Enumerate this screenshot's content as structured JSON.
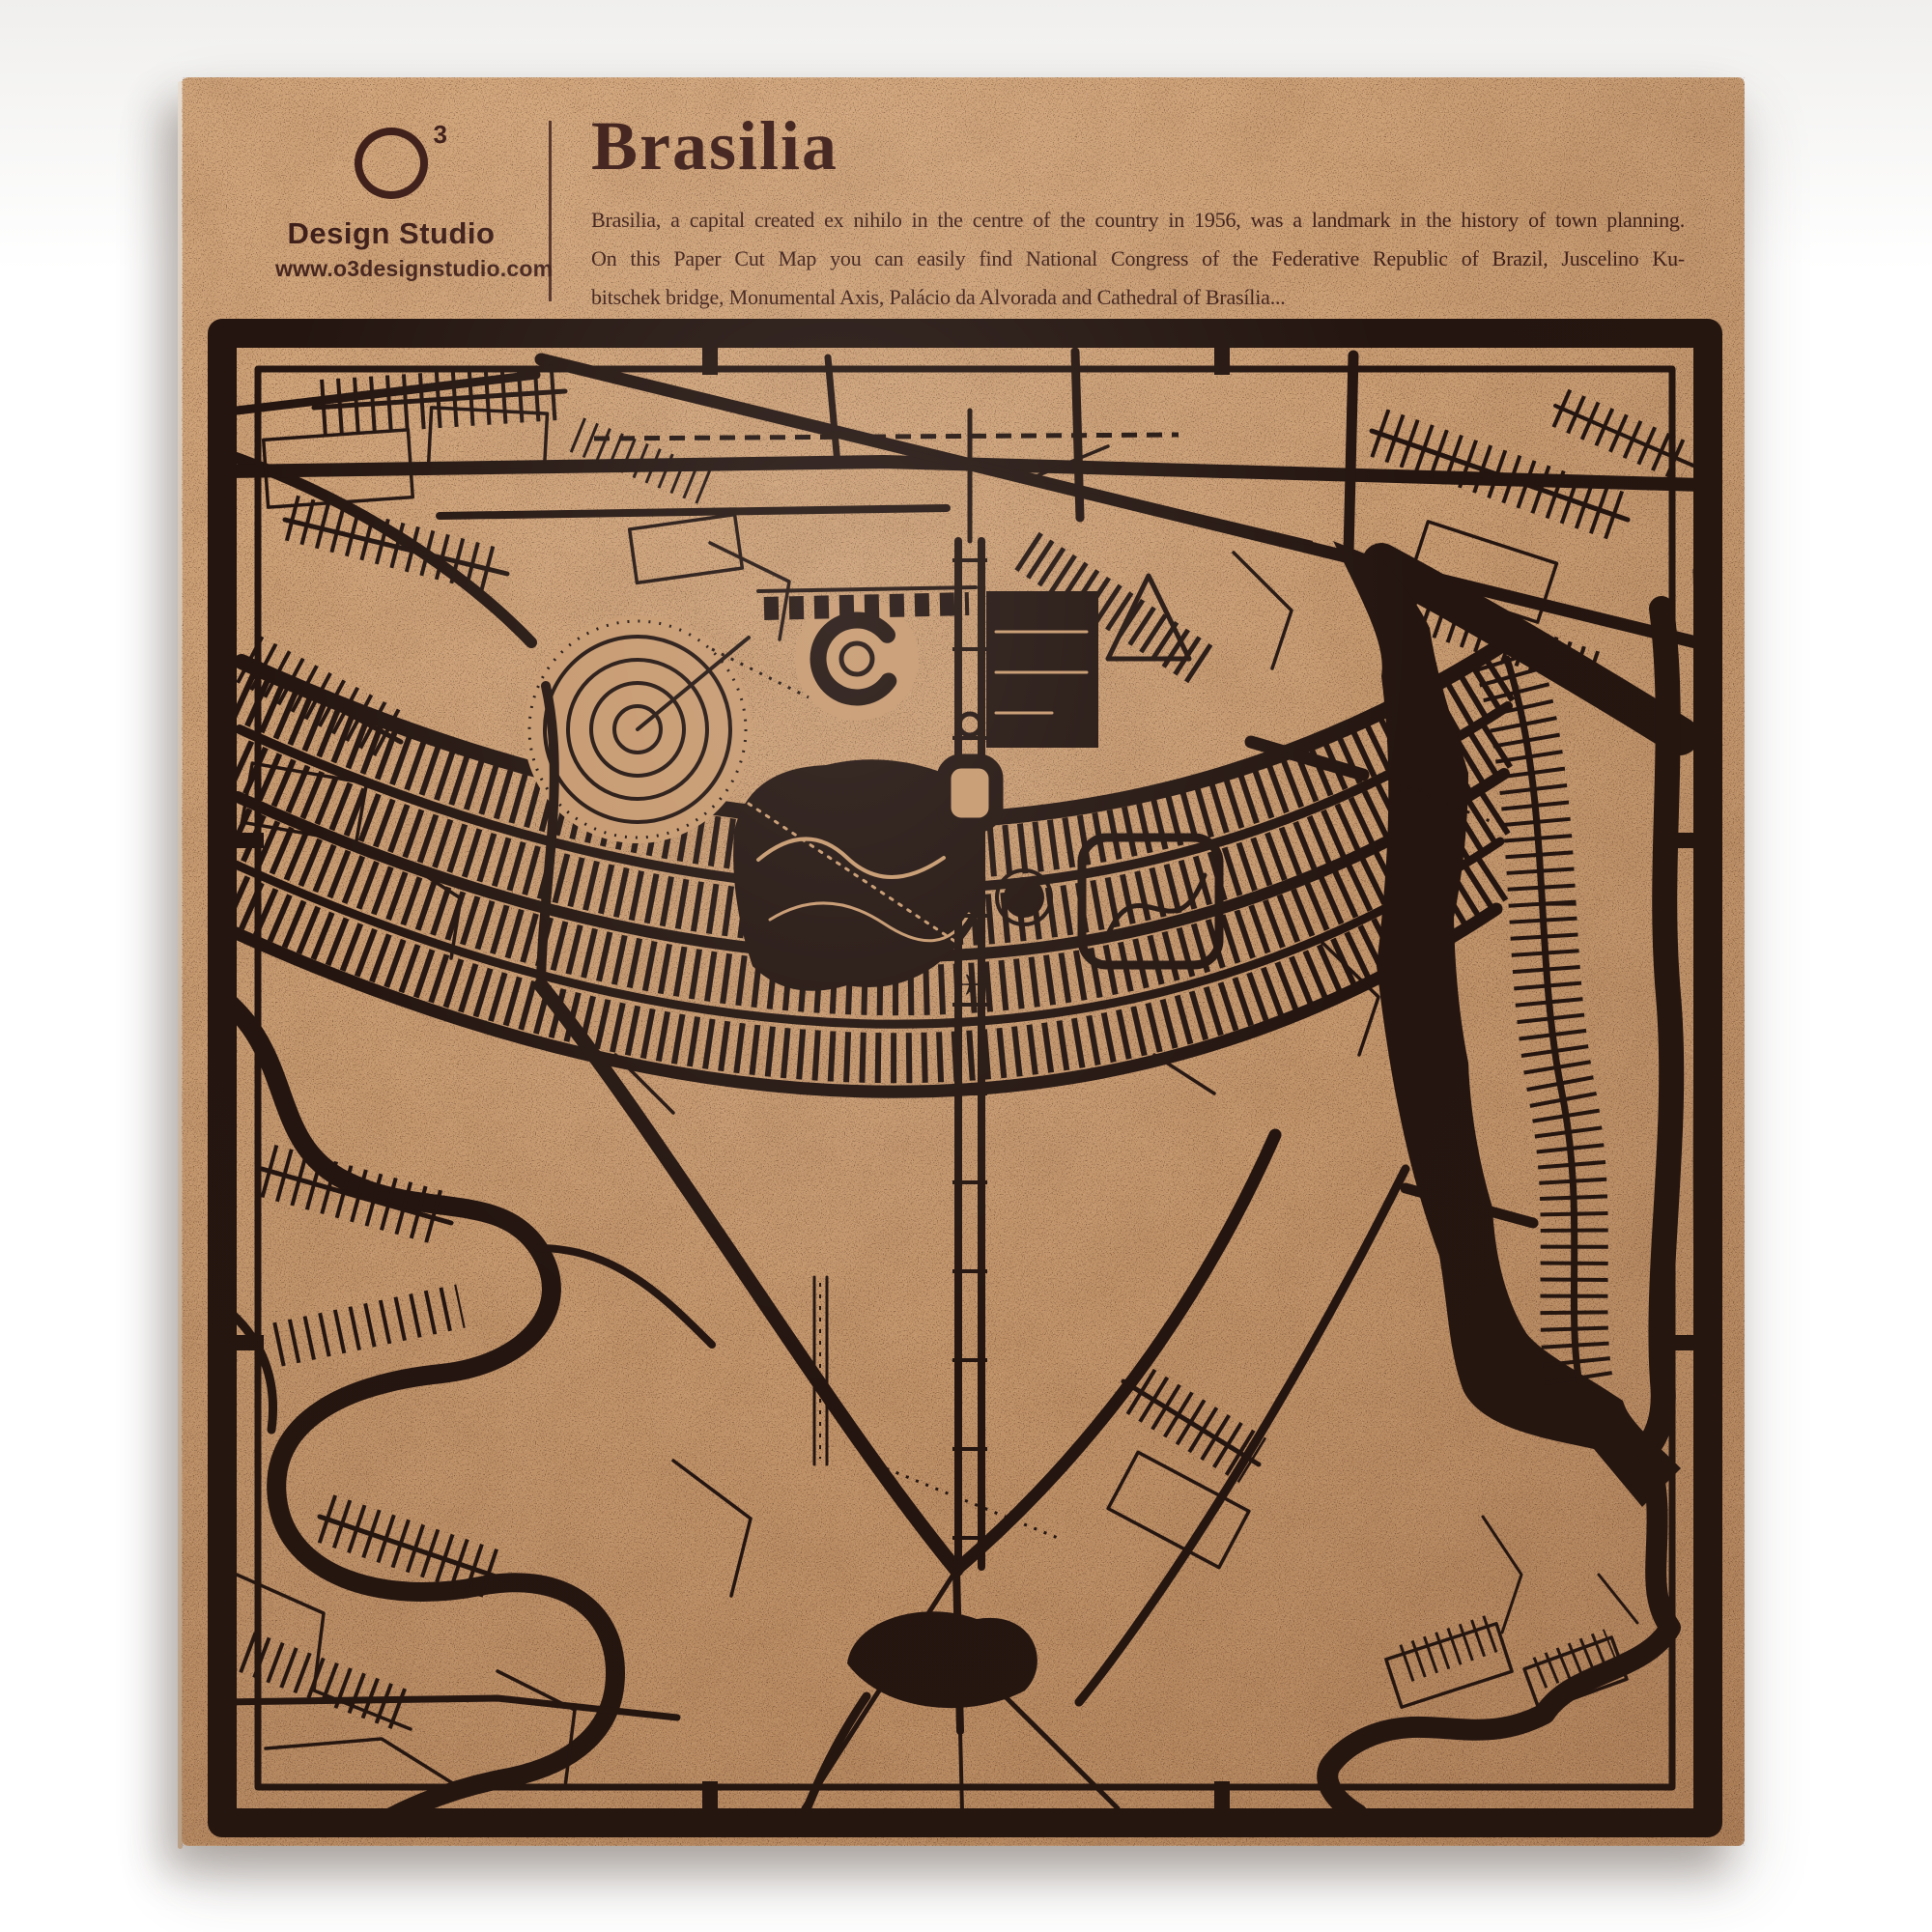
{
  "colors": {
    "page_bg": "#ffffff",
    "wall_tint": "#f0efed",
    "kraft": "#c6996f",
    "kraft_light": "#d2a67c",
    "kraft_dark": "#b8885f",
    "ink": "#241510",
    "text": "#40201a"
  },
  "header": {
    "logo": {
      "symbol": "O",
      "superscript": "3",
      "studio": "Design Studio",
      "website": "www.o3designstudio.com"
    },
    "title": "Brasilia",
    "description_lines": [
      "Brasilia, a capital created ex nihilo in the centre of the country in 1956, was a landmark in the history of town planning.",
      "On this Paper Cut Map you can easily find National Congress of the Federative Republic of Brazil, Juscelino Ku-",
      "bitschek bridge, Monumental Axis, Palácio da Alvorada and Cathedral of Brasília..."
    ]
  }
}
